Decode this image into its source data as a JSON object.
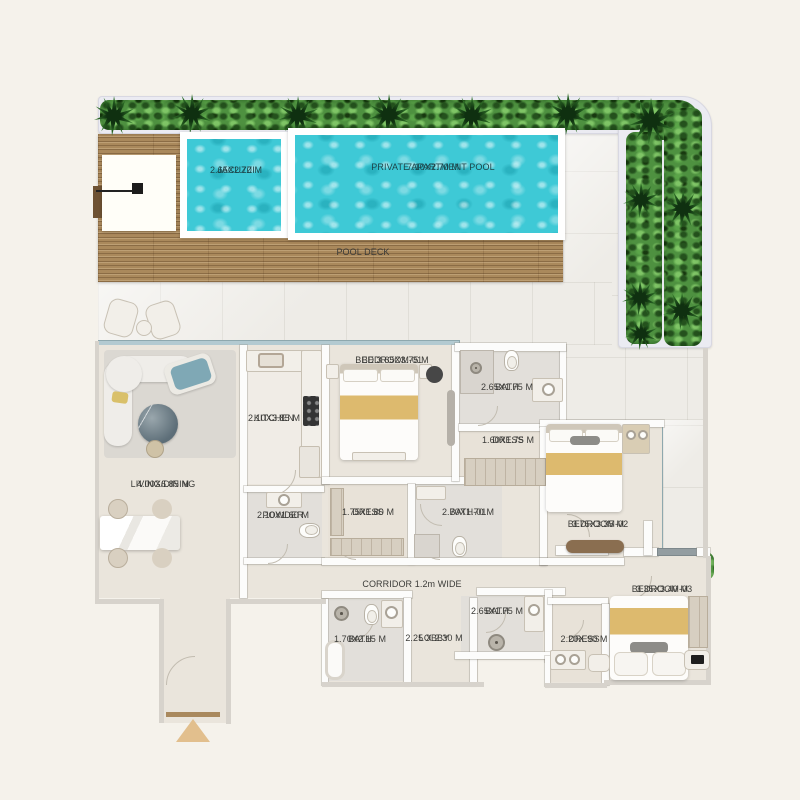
{
  "outdoor": {
    "jacuzzi": {
      "name": "JACUZZI",
      "dims": "2.65X2.70 M"
    },
    "pool": {
      "name": "PRIVATE APARTMENT POOL",
      "dims": "7.10X2.70 M"
    },
    "deck": {
      "name": "POOL DECK"
    }
  },
  "rooms": {
    "living": {
      "name": "LIVING/DINING",
      "dims": "4.00X6.85 M"
    },
    "kitchen": {
      "name": "KITCHEN",
      "dims": "2.10X3.85 M"
    },
    "bedroom1": {
      "name": "BEDROOM-01",
      "dims": "BED 3.65X3.75 M"
    },
    "bath_top": {
      "name": "BATH",
      "dims": "2.65X1.75 M"
    },
    "dress_top": {
      "name": "DRESS",
      "dims": "1.60X1.75 M"
    },
    "powder": {
      "name": "POWDER",
      "dims": "2.10X1.60 M"
    },
    "dress_mid": {
      "name": "DRESS",
      "dims": "1.75X1.80 M"
    },
    "bath01": {
      "name": "BATH-01",
      "dims": "2.70X1.70 M"
    },
    "bedroom2": {
      "name": "BEDROOM-02",
      "dims": "3.75X3.35 M"
    },
    "corridor": {
      "name": "CORRIDOR 1.2m WIDE"
    },
    "bath_bl": {
      "name": "BATH",
      "dims": "1.70X2.15 M"
    },
    "lobby": {
      "name": "LOBBY",
      "dims": "2.25 X 2.30 M"
    },
    "bath_br": {
      "name": "BATH",
      "dims": "2.65X1.75 M"
    },
    "dress_b": {
      "name": "DRESS",
      "dims": "2.20X.90 M"
    },
    "bedroom3": {
      "name": "BEDROOM-03",
      "dims": "3.35X3.40 M"
    }
  },
  "colors": {
    "background": "#f5f2eb",
    "water": "#3ec9d6",
    "deck_wood": "#aa895c",
    "plant_green": "#4e9140",
    "interior_floor": "#eae5dc",
    "wall": "#fcfcfb",
    "bed_accent": "#ddba6e",
    "glass": "#b3cad1",
    "label_text": "#3b3b38"
  }
}
